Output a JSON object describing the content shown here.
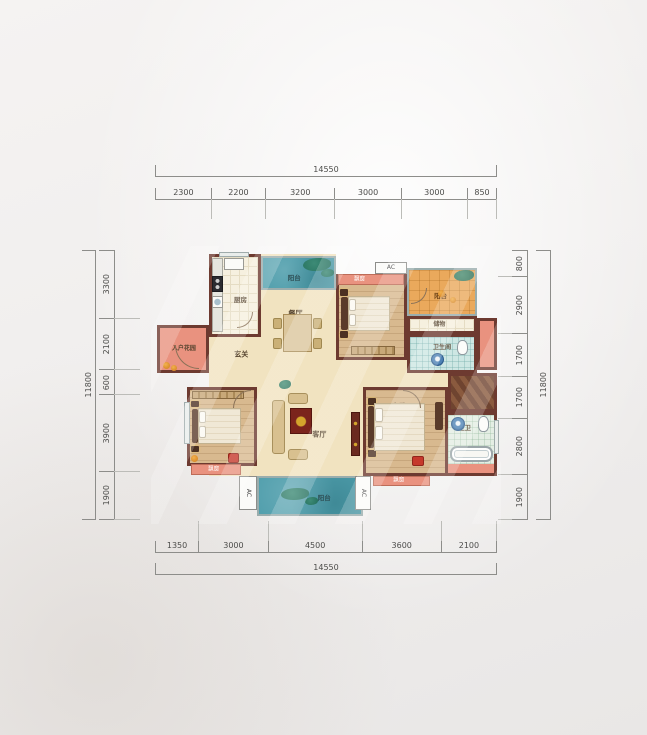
{
  "colors": {
    "wall": "#6d3a30",
    "balcony_teal": "#4e9dab",
    "balcony_orange": "#eaa95c",
    "bay_salmon": "#e9927f",
    "wood": "#d8b98f",
    "tile": "#f6f0df",
    "bath_tile": "#cde7e3",
    "dim_text": "#4c4c4a",
    "page_bg": "#f0eeed"
  },
  "rulers": {
    "top": {
      "total": "14550",
      "segments": [
        "2300",
        "2200",
        "3200",
        "3000",
        "3000",
        "850"
      ]
    },
    "bottom": {
      "total": "14550",
      "segments": [
        "1350",
        "3000",
        "4500",
        "3600",
        "2100"
      ]
    },
    "left": {
      "total": "11800",
      "segments": [
        "3300",
        "2100",
        "600",
        "3900",
        "1900"
      ]
    },
    "right": {
      "total": "11800",
      "segments": [
        "800",
        "2900",
        "1700",
        "1700",
        "2800",
        "1900"
      ]
    }
  },
  "plan": {
    "zones": [
      {
        "name": "floor-main",
        "x": 54,
        "y": 4,
        "w": 127,
        "h": 222
      },
      {
        "name": "floor-center",
        "x": 181,
        "y": 110,
        "w": 71,
        "h": 116
      },
      {
        "name": "floor-corridor",
        "x": 252,
        "y": 123,
        "w": 41,
        "h": 14
      }
    ],
    "rooms": [
      {
        "name": "entry-garden",
        "label": "入户花园",
        "cls": "f-salmon",
        "wall": "wall",
        "x": 2,
        "y": 75,
        "w": 52,
        "h": 48,
        "fs": 6,
        "lx": 52,
        "ly": 50
      },
      {
        "name": "kitchen",
        "label": "厨房",
        "cls": "f-tile",
        "wall": "wall",
        "x": 54,
        "y": 4,
        "w": 52,
        "h": 83,
        "fs": 6.5,
        "lx": 62,
        "ly": 56
      },
      {
        "name": "balcony-top",
        "label": "阳台",
        "cls": "f-teal",
        "wall": "wall-light",
        "x": 106,
        "y": 6,
        "w": 75,
        "h": 34,
        "fs": 6.5,
        "lc": "#2e4f55",
        "lx": 44,
        "ly": 66
      },
      {
        "name": "bedroom-2",
        "label": "次卧",
        "cls": "f-wood",
        "wall": "wall",
        "x": 181,
        "y": 24,
        "w": 71,
        "h": 86,
        "fs": 7,
        "lx": 32,
        "ly": 48
      },
      {
        "name": "bay-window-bedroom-2",
        "label": "飘窗",
        "cls": "f-bay",
        "wall": "wall-thin",
        "x": 183,
        "y": 24,
        "w": 66,
        "h": 11,
        "fs": 5.5,
        "lx": 32,
        "ly": 50
      },
      {
        "name": "ac-platform-top",
        "label": "AC",
        "cls": "f-ac",
        "x": 220,
        "y": 12,
        "w": 32,
        "h": 12,
        "fs": 6,
        "lx": 50,
        "ly": 50
      },
      {
        "name": "balcony-right",
        "label": "阳台",
        "cls": "f-orange",
        "wall": "wall-light",
        "x": 252,
        "y": 18,
        "w": 70,
        "h": 48,
        "fs": 6.5,
        "lc": "#6e4418",
        "lx": 48,
        "ly": 60
      },
      {
        "name": "storage",
        "label": "储物",
        "cls": "f-tile",
        "wall": "wall",
        "x": 252,
        "y": 66,
        "w": 70,
        "h": 18,
        "fs": 6,
        "lx": 46,
        "ly": 52
      },
      {
        "name": "bathroom",
        "label": "卫生间",
        "cls": "f-bath",
        "wall": "wall",
        "x": 252,
        "y": 84,
        "w": 70,
        "h": 39,
        "fs": 6,
        "lx": 50,
        "ly": 34
      },
      {
        "name": "duct-block",
        "cls": "f-salmon",
        "wall": "wall",
        "x": 322,
        "y": 68,
        "w": 20,
        "h": 52
      },
      {
        "name": "hatch-area",
        "cls": "f-hatch",
        "wall": "wall",
        "x": 293,
        "y": 123,
        "w": 49,
        "h": 39
      },
      {
        "name": "bedroom-3",
        "label": "次卧",
        "cls": "f-wood",
        "wall": "wall",
        "x": 32,
        "y": 137,
        "w": 70,
        "h": 79,
        "fs": 7,
        "lx": 42,
        "ly": 50
      },
      {
        "name": "master-bedroom",
        "label": "主卧",
        "cls": "f-wood",
        "wall": "wall",
        "x": 208,
        "y": 137,
        "w": 85,
        "h": 89,
        "fs": 7,
        "lx": 42,
        "ly": 20
      },
      {
        "name": "master-bathroom",
        "label": "主卫",
        "cls": "f-bath2",
        "wall": "wall",
        "x": 290,
        "y": 162,
        "w": 52,
        "h": 64,
        "fs": 6.5,
        "lx": 36,
        "ly": 22
      },
      {
        "name": "bay-window-master-bath",
        "cls": "f-salmon",
        "x": 293,
        "y": 214,
        "w": 46,
        "h": 9
      },
      {
        "name": "balcony-bottom",
        "label": "阳台",
        "cls": "f-teal",
        "wall": "wall-light",
        "x": 102,
        "y": 226,
        "w": 106,
        "h": 40,
        "fs": 6.5,
        "lc": "#2e4f55",
        "lx": 64,
        "ly": 56
      },
      {
        "name": "bay-window-bedroom-3",
        "label": "飘窗",
        "cls": "f-bay",
        "wall": "wall-thin",
        "x": 36,
        "y": 214,
        "w": 50,
        "h": 11,
        "fs": 5.5,
        "lx": 45,
        "ly": 50
      },
      {
        "name": "bay-window-master",
        "label": "飘窗",
        "cls": "f-bay",
        "wall": "wall-thin",
        "x": 218,
        "y": 226,
        "w": 57,
        "h": 10,
        "fs": 5.5,
        "lx": 45,
        "ly": 50
      },
      {
        "name": "ac-platform-bottom-left",
        "label": "AC",
        "cls": "f-ac",
        "vt": true,
        "x": 84,
        "y": 226,
        "w": 18,
        "h": 34,
        "fs": 6,
        "lx": 50,
        "ly": 50
      },
      {
        "name": "ac-platform-bottom-right",
        "label": "AC",
        "cls": "f-ac",
        "vt": true,
        "x": 200,
        "y": 226,
        "w": 16,
        "h": 34,
        "fs": 6,
        "lx": 50,
        "ly": 50
      },
      {
        "name": "hallway",
        "label": "玄关",
        "x": 54,
        "y": 87,
        "w": 52,
        "h": 40,
        "fs": 7,
        "lx": 62,
        "ly": 45
      },
      {
        "name": "dining-room",
        "label": "餐厅",
        "x": 106,
        "y": 40,
        "w": 75,
        "h": 62,
        "fs": 7,
        "lx": 46,
        "ly": 38
      },
      {
        "name": "living-room",
        "label": "客厅",
        "x": 106,
        "y": 102,
        "w": 146,
        "h": 124,
        "fs": 7,
        "lx": 40,
        "ly": 67
      },
      {
        "name": "window-kitchen",
        "cls": "f-window",
        "x": 64,
        "y": 2,
        "w": 30,
        "h": 5
      },
      {
        "name": "window-bedroom-3",
        "cls": "f-window",
        "x": 29,
        "y": 152,
        "w": 6,
        "h": 42
      },
      {
        "name": "window-master-bath",
        "cls": "f-window",
        "x": 339,
        "y": 170,
        "w": 5,
        "h": 34
      }
    ],
    "furniture": [
      {
        "name": "kitchen-counter",
        "t": "counter",
        "x": 57,
        "y": 8,
        "w": 11,
        "h": 74
      },
      {
        "name": "kitchen-sink",
        "t": "whitebox",
        "x": 69,
        "y": 8,
        "w": 20,
        "h": 12
      },
      {
        "name": "kitchen-stove",
        "t": "stove",
        "x": 57,
        "y": 26,
        "w": 11,
        "h": 16
      },
      {
        "name": "kitchen-basin",
        "t": "sinkbox",
        "x": 57,
        "y": 46,
        "w": 11,
        "h": 12
      },
      {
        "name": "dining-table",
        "t": "table",
        "x": 128,
        "y": 64,
        "w": 29,
        "h": 38
      },
      {
        "name": "dining-chair",
        "t": "chair",
        "x": 118,
        "y": 68,
        "w": 9,
        "h": 11
      },
      {
        "name": "dining-chair",
        "t": "chair",
        "x": 118,
        "y": 88,
        "w": 9,
        "h": 11
      },
      {
        "name": "dining-chair",
        "t": "chair",
        "x": 158,
        "y": 68,
        "w": 9,
        "h": 11
      },
      {
        "name": "dining-chair",
        "t": "chair",
        "x": 158,
        "y": 88,
        "w": 9,
        "h": 11
      },
      {
        "name": "bedroom2-nightstand",
        "t": "ns",
        "x": 185,
        "y": 39,
        "w": 8,
        "h": 7
      },
      {
        "name": "bedroom2-nightstand",
        "t": "ns",
        "x": 185,
        "y": 81,
        "w": 8,
        "h": 7
      },
      {
        "name": "bedroom2-headboard",
        "t": "bedhead",
        "x": 186,
        "y": 47,
        "w": 7,
        "h": 33
      },
      {
        "name": "bedroom2-bed",
        "t": "bed",
        "x": 193,
        "y": 46,
        "w": 42,
        "h": 35
      },
      {
        "name": "bedroom2-pillow",
        "t": "pillow",
        "x": 194,
        "y": 49,
        "w": 7,
        "h": 12
      },
      {
        "name": "bedroom2-pillow",
        "t": "pillow",
        "x": 194,
        "y": 64,
        "w": 7,
        "h": 12
      },
      {
        "name": "bedroom2-wardrobe",
        "t": "wardrobe",
        "x": 196,
        "y": 96,
        "w": 44,
        "h": 9
      },
      {
        "name": "bedroom3-wardrobe",
        "t": "wardrobe",
        "x": 37,
        "y": 141,
        "w": 52,
        "h": 8
      },
      {
        "name": "bedroom3-nightstand",
        "t": "ns",
        "x": 36,
        "y": 151,
        "w": 8,
        "h": 6
      },
      {
        "name": "bedroom3-nightstand",
        "t": "ns",
        "x": 36,
        "y": 196,
        "w": 8,
        "h": 6
      },
      {
        "name": "bedroom3-headboard",
        "t": "bedhead",
        "x": 37,
        "y": 159,
        "w": 6,
        "h": 34
      },
      {
        "name": "bedroom3-bed",
        "t": "bed",
        "x": 43,
        "y": 158,
        "w": 43,
        "h": 36
      },
      {
        "name": "bedroom3-pillow",
        "t": "pillow",
        "x": 44,
        "y": 161,
        "w": 7,
        "h": 12
      },
      {
        "name": "bedroom3-pillow",
        "t": "pillow",
        "x": 44,
        "y": 176,
        "w": 7,
        "h": 12
      },
      {
        "name": "master-nightstand",
        "t": "ns",
        "x": 213,
        "y": 148,
        "w": 8,
        "h": 7
      },
      {
        "name": "master-nightstand",
        "t": "ns",
        "x": 213,
        "y": 200,
        "w": 8,
        "h": 7
      },
      {
        "name": "master-headboard",
        "t": "bedhead",
        "x": 213,
        "y": 156,
        "w": 6,
        "h": 42
      },
      {
        "name": "master-bed",
        "t": "bed",
        "x": 219,
        "y": 153,
        "w": 51,
        "h": 48
      },
      {
        "name": "master-pillow",
        "t": "pillow",
        "x": 220,
        "y": 158,
        "w": 8,
        "h": 14
      },
      {
        "name": "master-pillow",
        "t": "pillow",
        "x": 220,
        "y": 176,
        "w": 8,
        "h": 14
      },
      {
        "name": "master-dresser",
        "t": "bedhead",
        "x": 280,
        "y": 152,
        "w": 8,
        "h": 28
      },
      {
        "name": "sofa-main",
        "t": "sofa",
        "x": 117,
        "y": 150,
        "w": 13,
        "h": 54
      },
      {
        "name": "armchair",
        "t": "sofa",
        "x": 133,
        "y": 143,
        "w": 20,
        "h": 11
      },
      {
        "name": "armchair",
        "t": "sofa",
        "x": 133,
        "y": 199,
        "w": 20,
        "h": 11
      },
      {
        "name": "coffee-table",
        "t": "coffee",
        "x": 135,
        "y": 158,
        "w": 22,
        "h": 26
      },
      {
        "name": "tv-cabinet",
        "t": "tv",
        "x": 196,
        "y": 162,
        "w": 9,
        "h": 44
      },
      {
        "name": "toilet",
        "t": "toilet",
        "x": 302,
        "y": 90,
        "w": 11,
        "h": 15
      },
      {
        "name": "bath-sink",
        "t": "sink",
        "x": 276,
        "y": 103,
        "w": 13,
        "h": 13
      },
      {
        "name": "master-bath-sink",
        "t": "sink",
        "x": 296,
        "y": 167,
        "w": 14,
        "h": 14
      },
      {
        "name": "master-toilet",
        "t": "toilet",
        "x": 323,
        "y": 166,
        "w": 11,
        "h": 16
      },
      {
        "name": "bathtub",
        "t": "tub",
        "x": 295,
        "y": 196,
        "w": 43,
        "h": 16
      },
      {
        "name": "plant",
        "t": "foliage",
        "x": 148,
        "y": 8,
        "w": 28,
        "h": 13
      },
      {
        "name": "plant",
        "t": "foliage",
        "x": 166,
        "y": 19,
        "w": 13,
        "h": 8
      },
      {
        "name": "plant",
        "t": "foliage",
        "x": 299,
        "y": 20,
        "w": 20,
        "h": 11
      },
      {
        "name": "fruit",
        "t": "fruit",
        "x": 283,
        "y": 40,
        "w": 7,
        "h": 7
      },
      {
        "name": "fruit",
        "t": "fruit",
        "x": 295,
        "y": 47,
        "w": 6,
        "h": 6
      },
      {
        "name": "plant",
        "t": "foliage",
        "x": 126,
        "y": 238,
        "w": 28,
        "h": 12
      },
      {
        "name": "plant",
        "t": "foliage",
        "x": 150,
        "y": 247,
        "w": 13,
        "h": 8
      },
      {
        "name": "plant",
        "t": "foliage",
        "x": 124,
        "y": 130,
        "w": 12,
        "h": 9
      },
      {
        "name": "fruit",
        "t": "fruit",
        "x": 8,
        "y": 112,
        "w": 7,
        "h": 7
      },
      {
        "name": "fruit",
        "t": "fruit",
        "x": 16,
        "y": 115,
        "w": 6,
        "h": 6
      },
      {
        "name": "fruit",
        "t": "fruit",
        "x": 36,
        "y": 205,
        "w": 7,
        "h": 7
      },
      {
        "name": "red-accent",
        "t": "red",
        "x": 73,
        "y": 203,
        "w": 11,
        "h": 10
      },
      {
        "name": "red-accent",
        "t": "red",
        "x": 257,
        "y": 206,
        "w": 12,
        "h": 10
      },
      {
        "name": "door-arc-entry",
        "t": "arc",
        "x": 20,
        "y": 95,
        "w": 24,
        "h": 24,
        "rot": 0
      },
      {
        "name": "door-arc-bedroom3",
        "t": "arc",
        "x": 78,
        "y": 140,
        "w": 18,
        "h": 18,
        "rot": 90
      },
      {
        "name": "door-arc-master",
        "t": "arc",
        "x": 248,
        "y": 140,
        "w": 18,
        "h": 18,
        "rot": 180
      },
      {
        "name": "door-arc-kitchen",
        "t": "arc",
        "x": 82,
        "y": 62,
        "w": 16,
        "h": 16,
        "rot": 270
      },
      {
        "name": "door-arc-balcony-right",
        "t": "arc",
        "x": 256,
        "y": 38,
        "w": 16,
        "h": 16,
        "rot": 270
      }
    ]
  }
}
